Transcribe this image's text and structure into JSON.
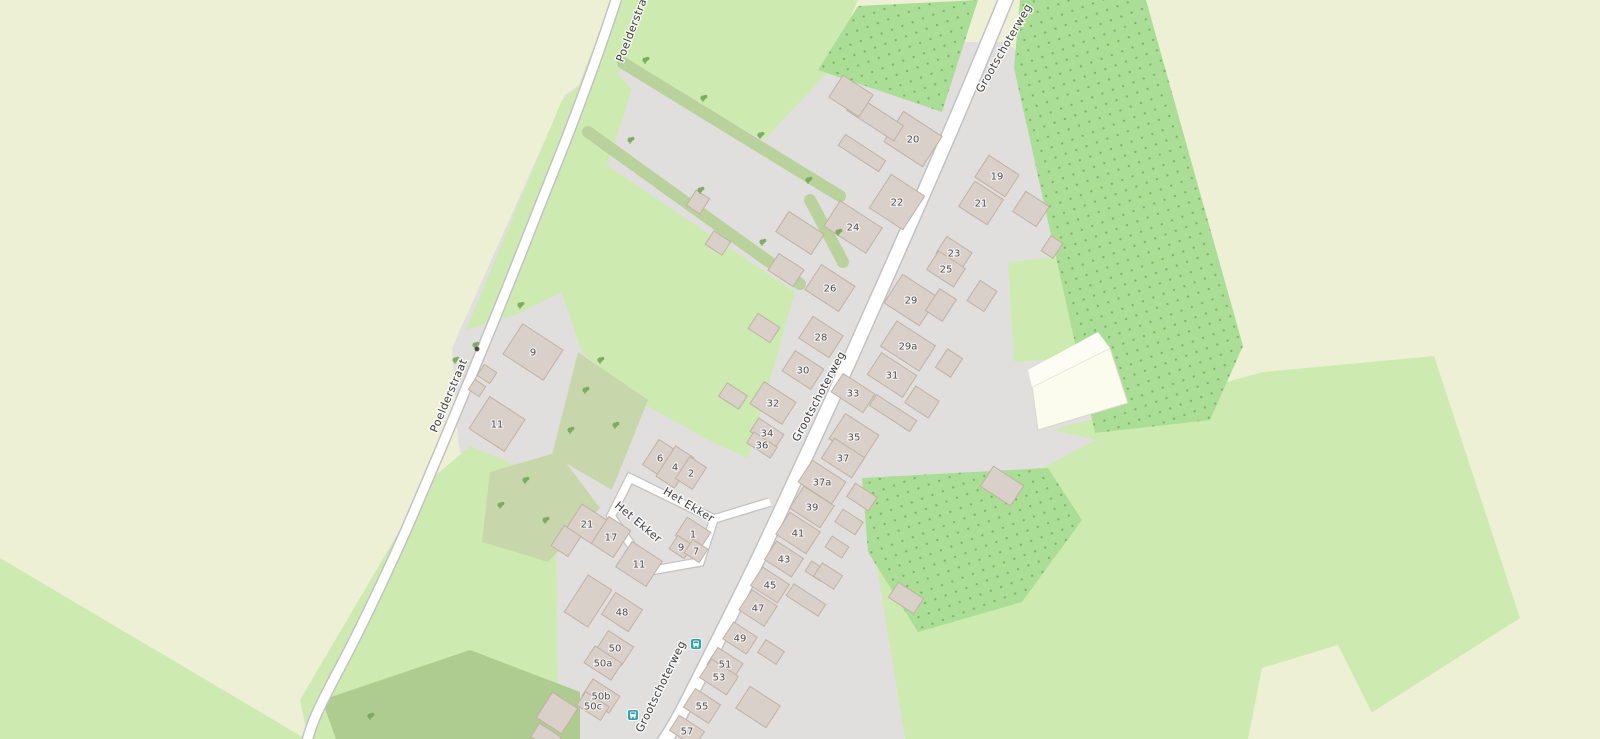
{
  "map": {
    "palette": {
      "farmland": "#eef0d5",
      "grass": "#cdebb0",
      "scrub": "#c8d7ab",
      "scrub_dark": "#aecb90",
      "orchard": "#aade96",
      "orchard_dot": "#76b55f",
      "residential": "#e1dfde",
      "building": "#d9d0c9",
      "building_outline": "#c0b2a1",
      "road_fill": "#ffffff",
      "road_casing": "#c2c2c2",
      "track_fill": "#fbfbee",
      "street_text": "#3c3c3c",
      "num_text": "#4d4d4d",
      "bus": "#2da3ad",
      "bush": "#76a75a",
      "hedge": "#b9d29b"
    },
    "street_labels": [
      {
        "text": "Poelderstraat",
        "x": 637,
        "y": 26,
        "rot": -69
      },
      {
        "text": "Poelderstraat",
        "x": 452,
        "y": 397,
        "rot": -67
      },
      {
        "text": "Grootschoterweg",
        "x": 1007,
        "y": 50,
        "rot": -60
      },
      {
        "text": "Grootschoterweg",
        "x": 822,
        "y": 398,
        "rot": -62
      },
      {
        "text": "Grootschoterweg",
        "x": 664,
        "y": 688,
        "rot": -64
      },
      {
        "text": "Het Ekker",
        "x": 687,
        "y": 508,
        "rot": 31
      },
      {
        "text": "Het Ekker",
        "x": 636,
        "y": 525,
        "rot": 40
      }
    ],
    "house_numbers": [
      {
        "label": "20",
        "x": 913,
        "y": 139,
        "w": 46,
        "h": 36
      },
      {
        "label": "22",
        "x": 897,
        "y": 202,
        "w": 40,
        "h": 40
      },
      {
        "label": "24",
        "x": 853,
        "y": 227,
        "w": 50,
        "h": 30
      },
      {
        "label": "26",
        "x": 830,
        "y": 288,
        "w": 40,
        "h": 30
      },
      {
        "label": "28",
        "x": 821,
        "y": 337,
        "w": 36,
        "h": 26
      },
      {
        "label": "30",
        "x": 803,
        "y": 370,
        "w": 34,
        "h": 24
      },
      {
        "label": "32",
        "x": 773,
        "y": 403,
        "w": 38,
        "h": 26
      },
      {
        "label": "34",
        "x": 767,
        "y": 433,
        "w": 30,
        "h": 16
      },
      {
        "label": "36",
        "x": 762,
        "y": 445,
        "w": 28,
        "h": 13
      },
      {
        "label": "6",
        "x": 660,
        "y": 458,
        "w": 22,
        "h": 30
      },
      {
        "label": "4",
        "x": 675,
        "y": 467,
        "w": 22,
        "h": 36
      },
      {
        "label": "2",
        "x": 691,
        "y": 473,
        "w": 20,
        "h": 26
      },
      {
        "label": "9",
        "x": 533,
        "y": 352,
        "w": 48,
        "h": 36
      },
      {
        "label": "11",
        "x": 497,
        "y": 424,
        "w": 42,
        "h": 38
      },
      {
        "label": "21",
        "x": 587,
        "y": 524,
        "w": 30,
        "h": 28
      },
      {
        "label": "17",
        "x": 611,
        "y": 537,
        "w": 26,
        "h": 32
      },
      {
        "label": "1",
        "x": 693,
        "y": 534,
        "w": 28,
        "h": 22
      },
      {
        "label": "9",
        "x": 681,
        "y": 547,
        "w": 18,
        "h": 16
      },
      {
        "label": "7",
        "x": 696,
        "y": 551,
        "w": 18,
        "h": 16
      },
      {
        "label": "11",
        "x": 639,
        "y": 564,
        "w": 36,
        "h": 30
      },
      {
        "label": "48",
        "x": 622,
        "y": 612,
        "w": 32,
        "h": 26
      },
      {
        "label": "50",
        "x": 615,
        "y": 648,
        "w": 30,
        "h": 22
      },
      {
        "label": "50a",
        "x": 603,
        "y": 663,
        "w": 32,
        "h": 20
      },
      {
        "label": "50b",
        "x": 601,
        "y": 696,
        "w": 32,
        "h": 20
      },
      {
        "label": "50c",
        "x": 593,
        "y": 706,
        "w": 28,
        "h": 16
      },
      {
        "label": "19",
        "x": 997,
        "y": 176,
        "w": 36,
        "h": 26
      },
      {
        "label": "21",
        "x": 981,
        "y": 203,
        "w": 34,
        "h": 30
      },
      {
        "label": "23",
        "x": 954,
        "y": 253,
        "w": 30,
        "h": 20
      },
      {
        "label": "25",
        "x": 946,
        "y": 269,
        "w": 32,
        "h": 22
      },
      {
        "label": "29",
        "x": 911,
        "y": 300,
        "w": 42,
        "h": 34
      },
      {
        "label": "29a",
        "x": 908,
        "y": 346,
        "w": 46,
        "h": 30
      },
      {
        "label": "31",
        "x": 892,
        "y": 375,
        "w": 42,
        "h": 26
      },
      {
        "label": "33",
        "x": 853,
        "y": 393,
        "w": 38,
        "h": 22
      },
      {
        "label": "35",
        "x": 854,
        "y": 437,
        "w": 40,
        "h": 30
      },
      {
        "label": "37",
        "x": 843,
        "y": 458,
        "w": 36,
        "h": 24
      },
      {
        "label": "37a",
        "x": 822,
        "y": 482,
        "w": 40,
        "h": 26
      },
      {
        "label": "39",
        "x": 812,
        "y": 507,
        "w": 36,
        "h": 26
      },
      {
        "label": "41",
        "x": 798,
        "y": 533,
        "w": 36,
        "h": 26
      },
      {
        "label": "43",
        "x": 784,
        "y": 559,
        "w": 32,
        "h": 22
      },
      {
        "label": "45",
        "x": 770,
        "y": 585,
        "w": 32,
        "h": 22
      },
      {
        "label": "47",
        "x": 758,
        "y": 608,
        "w": 30,
        "h": 24
      },
      {
        "label": "49",
        "x": 740,
        "y": 638,
        "w": 28,
        "h": 20
      },
      {
        "label": "51",
        "x": 725,
        "y": 664,
        "w": 30,
        "h": 20
      },
      {
        "label": "53",
        "x": 719,
        "y": 677,
        "w": 32,
        "h": 22
      },
      {
        "label": "55",
        "x": 702,
        "y": 706,
        "w": 30,
        "h": 22
      },
      {
        "label": "57",
        "x": 687,
        "y": 731,
        "w": 30,
        "h": 18
      }
    ],
    "buildings_unlabeled": [
      {
        "x": 875,
        "y": 118,
        "w": 56,
        "h": 18
      },
      {
        "x": 851,
        "y": 96,
        "w": 36,
        "h": 26
      },
      {
        "x": 862,
        "y": 153,
        "w": 48,
        "h": 13
      },
      {
        "x": 800,
        "y": 233,
        "w": 42,
        "h": 24
      },
      {
        "x": 786,
        "y": 270,
        "w": 30,
        "h": 20
      },
      {
        "x": 764,
        "y": 328,
        "w": 26,
        "h": 18
      },
      {
        "x": 733,
        "y": 396,
        "w": 24,
        "h": 16
      },
      {
        "x": 698,
        "y": 202,
        "w": 16,
        "h": 18
      },
      {
        "x": 718,
        "y": 243,
        "w": 20,
        "h": 16
      },
      {
        "x": 588,
        "y": 601,
        "w": 28,
        "h": 44
      },
      {
        "x": 566,
        "y": 541,
        "w": 20,
        "h": 24
      },
      {
        "x": 557,
        "y": 713,
        "w": 30,
        "h": 30
      },
      {
        "x": 546,
        "y": 737,
        "w": 26,
        "h": 16
      },
      {
        "x": 487,
        "y": 374,
        "w": 15,
        "h": 13
      },
      {
        "x": 477,
        "y": 388,
        "w": 13,
        "h": 12
      },
      {
        "x": 1031,
        "y": 209,
        "w": 28,
        "h": 24
      },
      {
        "x": 1052,
        "y": 247,
        "w": 14,
        "h": 18
      },
      {
        "x": 982,
        "y": 296,
        "w": 20,
        "h": 24
      },
      {
        "x": 941,
        "y": 305,
        "w": 20,
        "h": 26
      },
      {
        "x": 949,
        "y": 363,
        "w": 18,
        "h": 22
      },
      {
        "x": 922,
        "y": 402,
        "w": 28,
        "h": 20
      },
      {
        "x": 893,
        "y": 413,
        "w": 48,
        "h": 13
      },
      {
        "x": 1002,
        "y": 486,
        "w": 36,
        "h": 24
      },
      {
        "x": 862,
        "y": 497,
        "w": 26,
        "h": 16
      },
      {
        "x": 849,
        "y": 522,
        "w": 24,
        "h": 15
      },
      {
        "x": 837,
        "y": 547,
        "w": 20,
        "h": 13
      },
      {
        "x": 816,
        "y": 571,
        "w": 18,
        "h": 12
      },
      {
        "x": 828,
        "y": 576,
        "w": 24,
        "h": 16
      },
      {
        "x": 806,
        "y": 600,
        "w": 38,
        "h": 14
      },
      {
        "x": 771,
        "y": 652,
        "w": 22,
        "h": 15
      },
      {
        "x": 758,
        "y": 707,
        "w": 36,
        "h": 26
      },
      {
        "x": 906,
        "y": 598,
        "w": 30,
        "h": 18
      }
    ],
    "bus_stops": [
      {
        "x": 696,
        "y": 644
      },
      {
        "x": 633,
        "y": 715
      }
    ],
    "road_marker": {
      "x": 477,
      "y": 349
    },
    "scrub_symbols": [
      {
        "x": 645,
        "y": 60
      },
      {
        "x": 703,
        "y": 98
      },
      {
        "x": 760,
        "y": 135
      },
      {
        "x": 808,
        "y": 180
      },
      {
        "x": 630,
        "y": 140
      },
      {
        "x": 700,
        "y": 190
      },
      {
        "x": 762,
        "y": 242
      },
      {
        "x": 838,
        "y": 232
      },
      {
        "x": 520,
        "y": 305
      },
      {
        "x": 475,
        "y": 345
      },
      {
        "x": 455,
        "y": 360
      },
      {
        "x": 600,
        "y": 360
      },
      {
        "x": 585,
        "y": 390
      },
      {
        "x": 615,
        "y": 425
      },
      {
        "x": 570,
        "y": 430
      },
      {
        "x": 525,
        "y": 480
      },
      {
        "x": 500,
        "y": 505
      },
      {
        "x": 545,
        "y": 520
      },
      {
        "x": 370,
        "y": 716
      }
    ]
  }
}
